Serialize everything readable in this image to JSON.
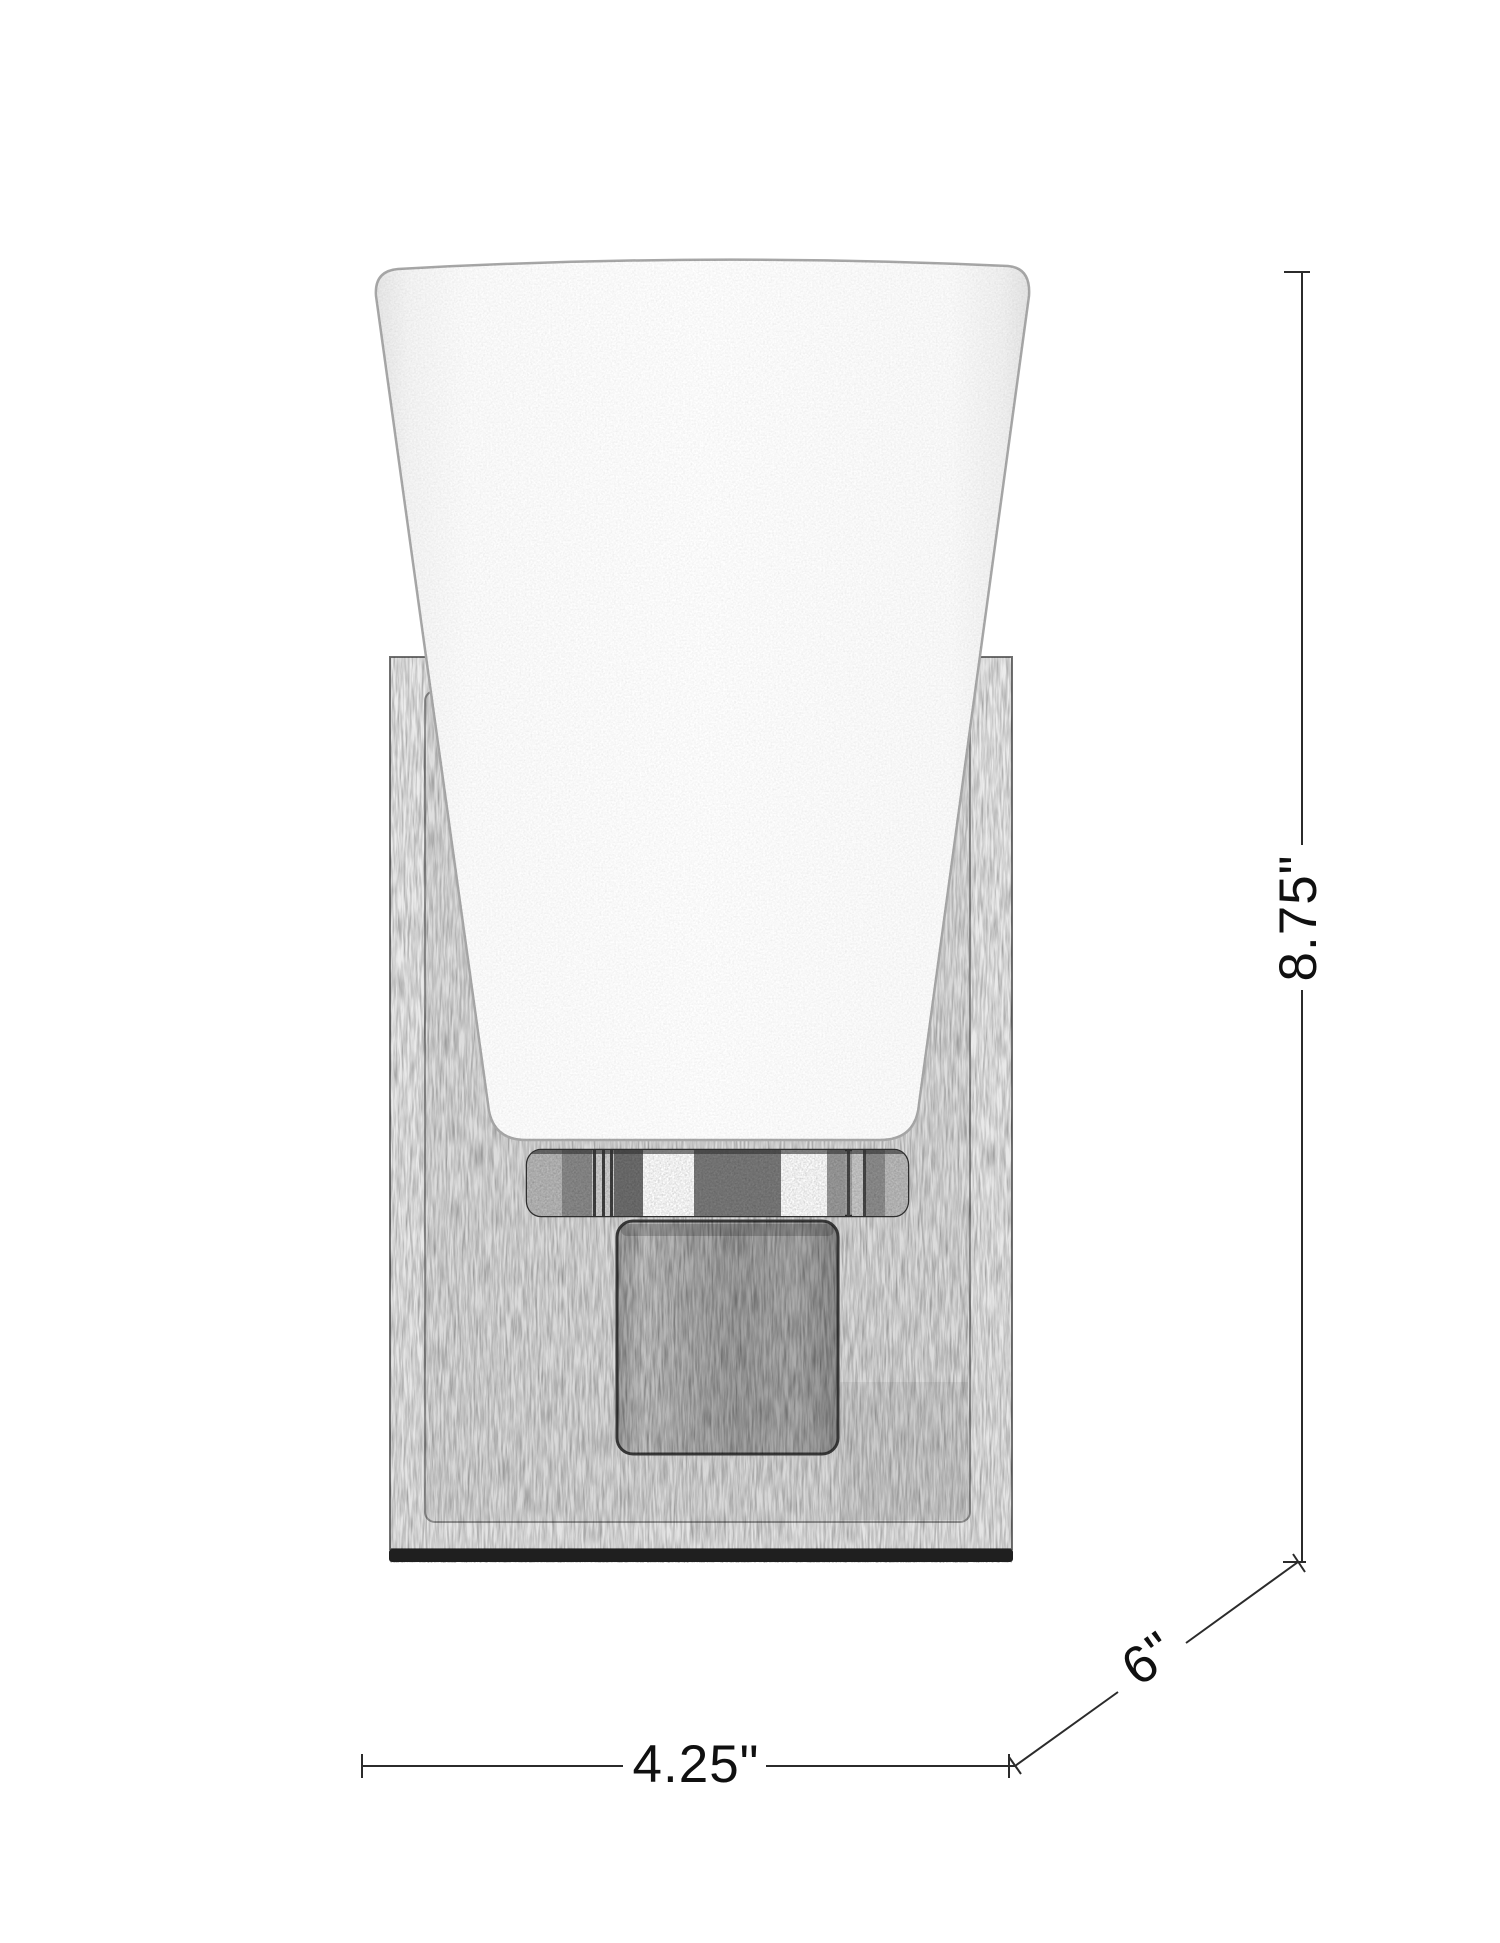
{
  "drawing": {
    "kind": "product-dimension-line-drawing",
    "subject": "single-light wall sconce with tapered frosted glass shade on rectangular backplate",
    "background_color": "#ffffff",
    "line_color": "#2b2b2b",
    "labels": {
      "height": "8.75\"",
      "width": "4.25\"",
      "depth": "6\""
    },
    "parts": [
      {
        "name": "tapered-glass-shade",
        "fill": "#fdfdfd",
        "outline": "#a7a7a7"
      },
      {
        "name": "rectangular-backplate",
        "fill": "#ebebeb",
        "outline": "#707070"
      },
      {
        "name": "metal-fitter-collar",
        "fill": "#a3a3a3",
        "outline": "#2e2e2e"
      },
      {
        "name": "square-arm-block",
        "fill": "#ababab",
        "outline": "#383838"
      }
    ]
  }
}
